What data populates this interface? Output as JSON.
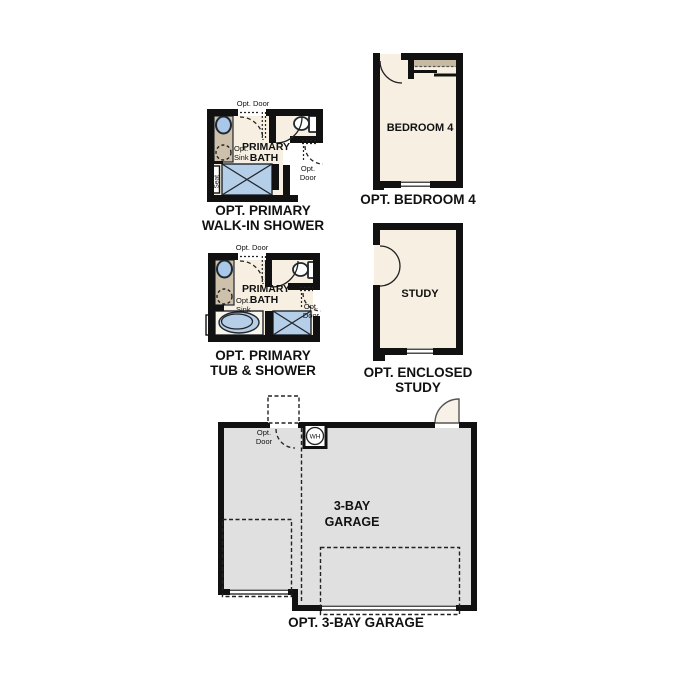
{
  "colors": {
    "wall": "#111111",
    "outline": "#22272e",
    "line": "#222222",
    "text": "#111111",
    "room": "#f6efe2",
    "vanity": "#cec1ab",
    "shelf": "#c7baa3",
    "fixture": "#b6cfe9",
    "sinkblue": "#a9c7e8",
    "tubfill": "#faf5ea",
    "garage": "#e0e0e0",
    "doorleaf": "#f7f1e7"
  },
  "plans": {
    "walkin": {
      "opt_door_top": "Opt. Door",
      "room_line1": "PRIMARY",
      "room_line2": "BATH",
      "opt_sink_line1": "Opt.",
      "opt_sink_line2": "Sink",
      "seat": "Seat",
      "opt_door_right_line1": "Opt.",
      "opt_door_right_line2": "Door",
      "title_line1": "OPT. PRIMARY",
      "title_line2": "WALK-IN SHOWER"
    },
    "bedroom4": {
      "room": "BEDROOM 4",
      "title": "OPT. BEDROOM 4"
    },
    "tub_shower": {
      "opt_door_top": "Opt. Door",
      "room_line1": "PRIMARY",
      "room_line2": "BATH",
      "opt_sink_line1": "Opt.",
      "opt_sink_line2": "Sink",
      "opt_door_right_line1": "Opt.",
      "opt_door_right_line2": "Door",
      "title_line1": "OPT. PRIMARY",
      "title_line2": "TUB & SHOWER"
    },
    "study": {
      "room": "STUDY",
      "title_line1": "OPT. ENCLOSED",
      "title_line2": "STUDY"
    },
    "garage": {
      "opt_door_line1": "Opt.",
      "opt_door_line2": "Door",
      "water_heater": "WH",
      "room_line1": "3-BAY",
      "room_line2": "GARAGE",
      "title": "OPT. 3-BAY GARAGE"
    }
  }
}
